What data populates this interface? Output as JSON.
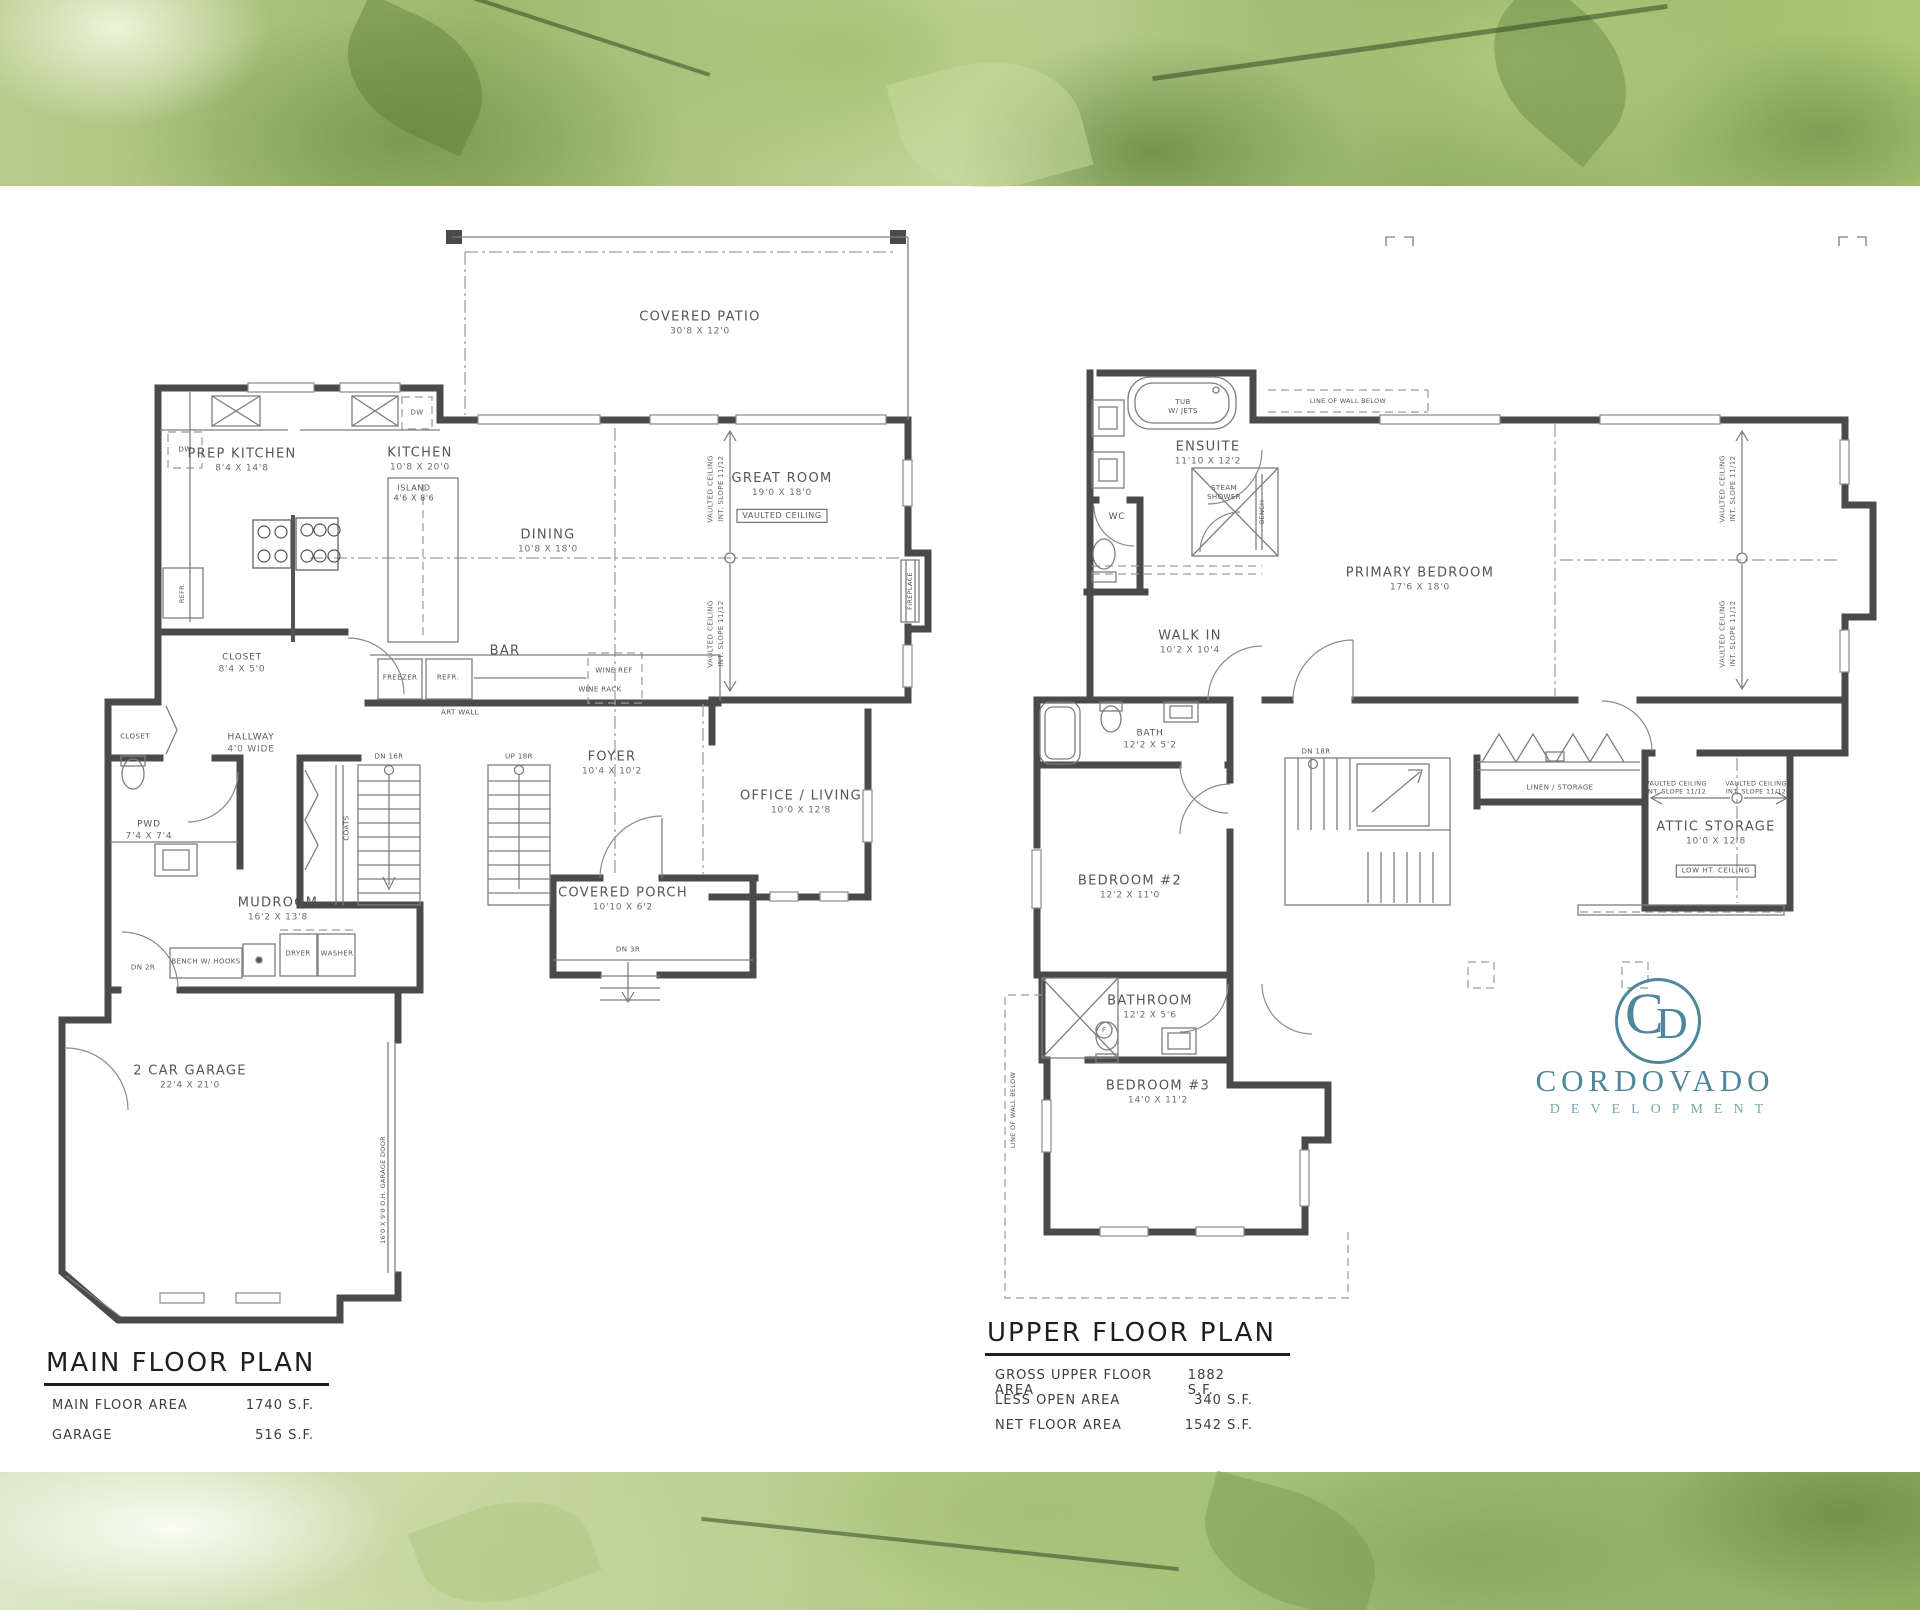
{
  "logo": {
    "monogram_c": "C",
    "monogram_d": "D",
    "name": "CORDOVADO",
    "subtitle": "DEVELOPMENT",
    "color": "#4e879b"
  },
  "main_plan": {
    "title": "MAIN FLOOR PLAN",
    "stats": [
      {
        "label": "MAIN FLOOR AREA",
        "value": "1740 S.F."
      },
      {
        "label": "GARAGE",
        "value": "516 S.F."
      }
    ],
    "rooms": {
      "covered_patio": {
        "name": "COVERED PATIO",
        "dims": "30'8 X 12'0"
      },
      "prep_kitchen": {
        "name": "PREP KITCHEN",
        "dims": "8'4 X 14'8"
      },
      "kitchen": {
        "name": "KITCHEN",
        "dims": "10'8 X 20'0"
      },
      "island": {
        "name": "ISLAND",
        "dims": "4'6 X 8'6"
      },
      "dining": {
        "name": "DINING",
        "dims": "10'8 X 18'0"
      },
      "great_room": {
        "name": "GREAT ROOM",
        "dims": "19'0 X 18'0",
        "tag": "VAULTED CEILING"
      },
      "bar": {
        "name": "BAR"
      },
      "closet": {
        "name": "CLOSET",
        "dims": "8'4 X 5'0"
      },
      "closet_small": {
        "name": "CLOSET"
      },
      "hallway": {
        "name": "HALLWAY",
        "dims": "4'0 WIDE"
      },
      "pwd": {
        "name": "PWD",
        "dims": "7'4 X 7'4"
      },
      "mudroom": {
        "name": "MUDROOM",
        "dims": "16'2 X 13'8"
      },
      "foyer": {
        "name": "FOYER",
        "dims": "10'4 X 10'2"
      },
      "covered_porch": {
        "name": "COVERED PORCH",
        "dims": "10'10 X 6'2"
      },
      "office_living": {
        "name": "OFFICE / LIVING",
        "dims": "10'0 X 12'8"
      },
      "garage": {
        "name": "2 CAR GARAGE",
        "dims": "22'4 X 21'0"
      }
    },
    "ann": {
      "freezer": "FREEZER",
      "refr": "REFR.",
      "wine_ref": "WINE REF",
      "wine_rack": "WINE RACK",
      "art_wall": "ART WALL",
      "bench": "BENCH W/ HOOKS",
      "dryer": "DRYER",
      "washer": "WASHER",
      "coats": "COATS",
      "dw": "DW",
      "refr2": "REFR.",
      "fireplace": "FIREPLACE",
      "dn16": "DN 16R",
      "up18": "UP 18R",
      "dn3": "DN 3R",
      "dn2": "DN 2R",
      "garage_door": "16'0 X 9'0 O.H. GARAGE DOOR",
      "vc1": "VAULTED CEILING",
      "vc2": "INT. SLOPE 11/12"
    }
  },
  "upper_plan": {
    "title": "UPPER FLOOR PLAN",
    "stats": [
      {
        "label": "GROSS UPPER FLOOR AREA",
        "value": "1882 S.F."
      },
      {
        "label": "LESS OPEN AREA",
        "value": "340 S.F."
      },
      {
        "label": "NET FLOOR AREA",
        "value": "1542 S.F."
      }
    ],
    "rooms": {
      "ensuite": {
        "name": "ENSUITE",
        "dims": "11'10 X 12'2"
      },
      "wc": {
        "name": "WC"
      },
      "primary_bedroom": {
        "name": "PRIMARY BEDROOM",
        "dims": "17'6 X 18'0"
      },
      "walk_in": {
        "name": "WALK IN",
        "dims": "10'2 X 10'4"
      },
      "bath": {
        "name": "BATH",
        "dims": "12'2 X 5'2"
      },
      "bedroom2": {
        "name": "BEDROOM #2",
        "dims": "12'2 X 11'0"
      },
      "bathroom": {
        "name": "BATHROOM",
        "dims": "12'2 X 5'6"
      },
      "bedroom3": {
        "name": "BEDROOM #3",
        "dims": "14'0 X 11'2"
      },
      "attic": {
        "name": "ATTIC STORAGE",
        "dims": "10'0 X 12'8",
        "tag": "LOW HT. CEILING"
      },
      "linen": {
        "name": "LINEN / STORAGE"
      }
    },
    "ann": {
      "tub1": "TUB",
      "tub2": "W/ JETS",
      "steam1": "STEAM",
      "steam2": "SHOWER",
      "bench": "BENCH",
      "wall_below": "LINE OF WALL BELOW",
      "dn18": "DN 18R",
      "f": "F",
      "vc1": "VAULTED CEILING",
      "vc2": "INT. SLOPE 11/12"
    }
  }
}
